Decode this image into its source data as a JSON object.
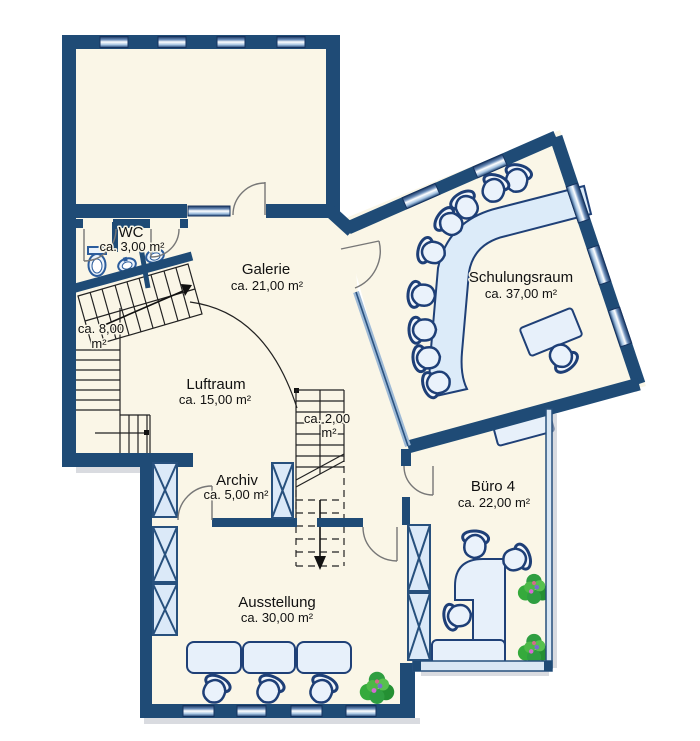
{
  "plan": {
    "type": "floor-plan",
    "colors": {
      "wall": "#1F4B76",
      "floor": "#FAF6E7",
      "furniture": "#E7F0FA",
      "furniture_stroke": "#1F4077",
      "glass": "#D9E7F4",
      "plant_green": "#2F9E41",
      "background": "#FFFFFF"
    },
    "rooms": {
      "wc": {
        "name": "WC",
        "area": "ca. 3,00 m²"
      },
      "galerie": {
        "name": "Galerie",
        "area": "ca. 21,00 m²"
      },
      "schulungsraum": {
        "name": "Schulungsraum",
        "area": "ca. 37,00 m²"
      },
      "stair8": {
        "line1": "ca. 8,00",
        "line2": "m²"
      },
      "luftraum": {
        "name": "Luftraum",
        "area": "ca. 15,00 m²"
      },
      "stair2": {
        "line1": "ca. 2,00",
        "line2": "m²"
      },
      "archiv": {
        "name": "Archiv",
        "area": "ca. 5,00 m²"
      },
      "buero4": {
        "name": "Büro 4",
        "area": "ca. 22,00 m²"
      },
      "ausstellung": {
        "name": "Ausstellung",
        "area": "ca. 30,00 m²"
      }
    }
  }
}
